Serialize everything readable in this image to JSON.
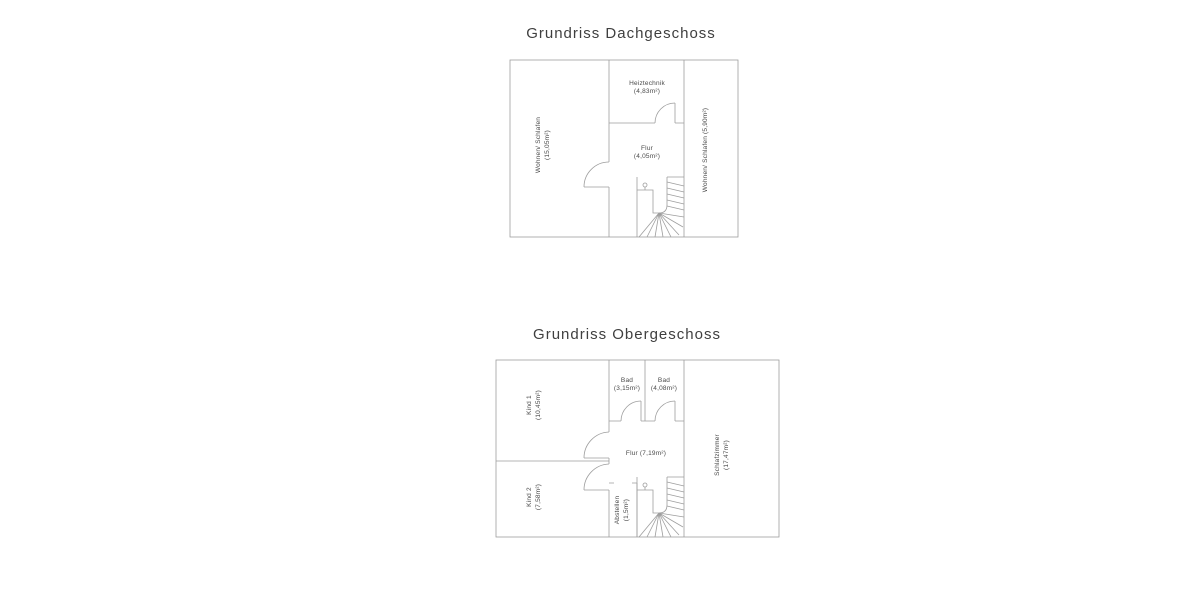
{
  "colors": {
    "wall_line": "#9e9e9e",
    "label_text": "#4a4a4a",
    "title_text": "#3f3f3f",
    "background": "#ffffff"
  },
  "dachgeschoss": {
    "title": "Grundriss Dachgeschoss",
    "room_left_name": "Wohnen/ Schlafen",
    "room_left_area": "(15,05m²)",
    "heiztechnik_name": "Heiztechnik",
    "heiztechnik_area": "(4,83m²)",
    "flur_name": "Flur",
    "flur_area": "(4,05m²)",
    "room_right_label": "Wohnen/ Schlafen (5,90m²)"
  },
  "obergeschoss": {
    "title": "Grundriss Obergeschoss",
    "kind1_name": "Kind 1",
    "kind1_area": "(10,45m²)",
    "kind2_name": "Kind 2",
    "kind2_area": "(7,58m²)",
    "bad1_name": "Bad",
    "bad1_area": "(3,15m²)",
    "bad2_name": "Bad",
    "bad2_area": "(4,08m²)",
    "flur_label": "Flur (7,19m²)",
    "abstellen_name": "Abstellen",
    "abstellen_area": "(1,5m²)",
    "schlafzimmer_name": "Schlafzimmer",
    "schlafzimmer_area": "(17,47m²)"
  }
}
